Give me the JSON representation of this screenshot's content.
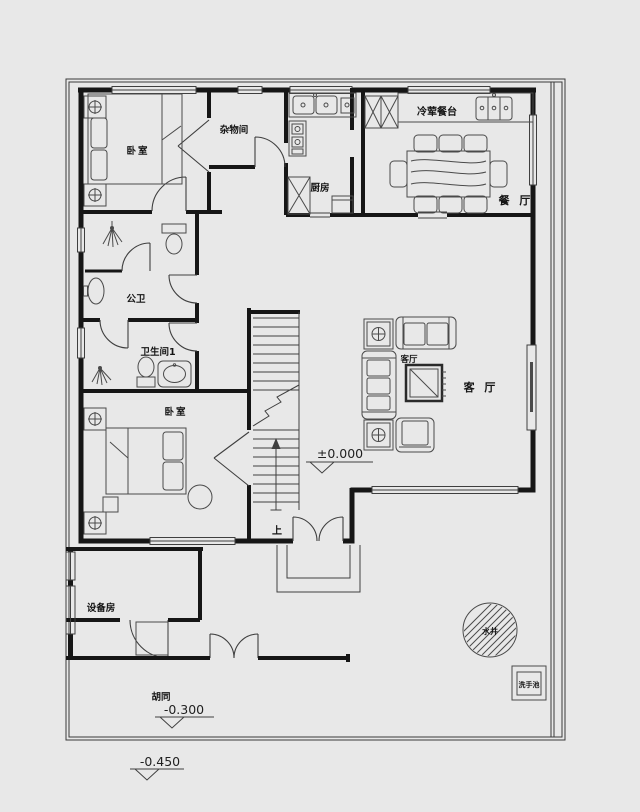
{
  "labels": {
    "bedroom_top": "卧室",
    "storage": "杂物间",
    "kitchen": "厨房",
    "cold_counter": "冷荤餐台",
    "dining": "餐 厅",
    "public_bath": "公卫",
    "bath1": "卫生间1",
    "bedroom_bottom": "卧室",
    "living_small": "客厅",
    "living_large": "客 厅",
    "stairs_up": "上",
    "equipment": "设备房",
    "alley": "胡同",
    "well": "水井",
    "wash_basin": "洗手池"
  },
  "elevations": {
    "ground": "±0.000",
    "alley": "-0.300",
    "road": "-0.450"
  },
  "colors": {
    "background": "#e8e8e8",
    "wall": "#161616",
    "furniture": "#4a4a4a",
    "boundary": "#3a3a3a"
  }
}
